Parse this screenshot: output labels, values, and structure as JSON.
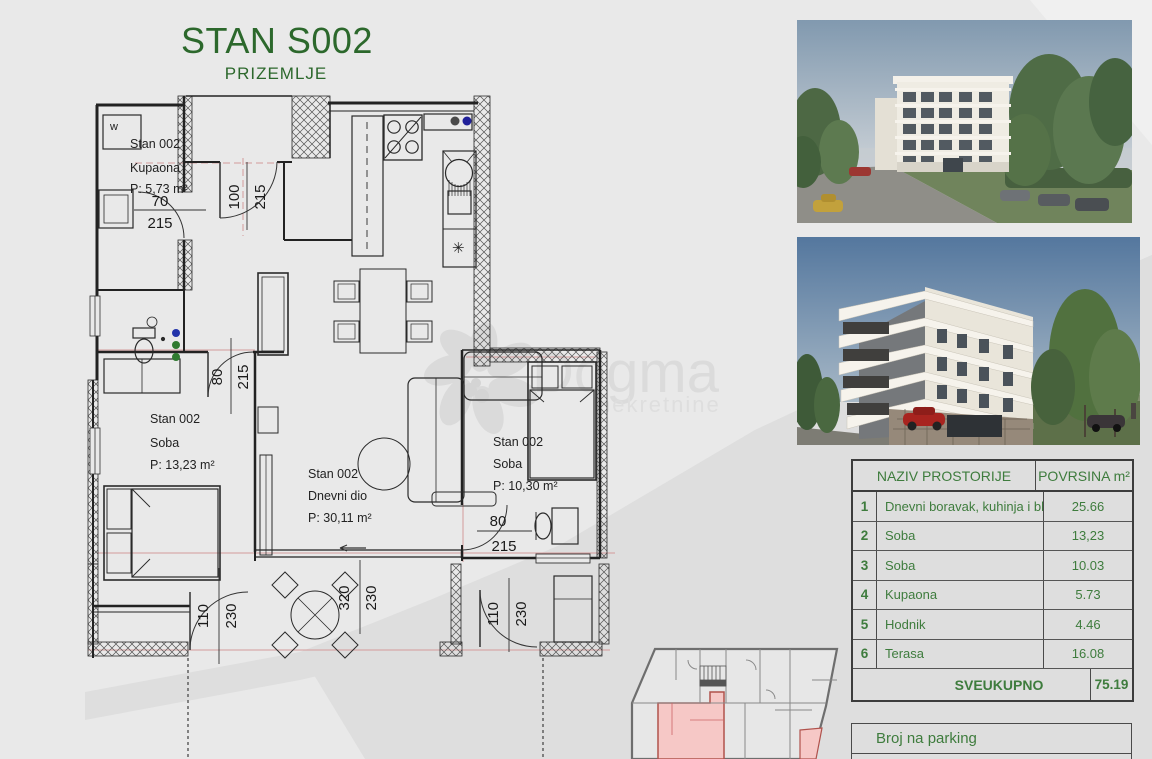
{
  "title": {
    "main": "STAN S002",
    "sub": "PRIZEMLJE"
  },
  "floorplan": {
    "rooms": {
      "kupaona": {
        "l1": "Stan 002",
        "l2": "Kupaona",
        "area": "P: 5,73 m²"
      },
      "soba1": {
        "l1": "Stan 002",
        "l2": "Soba",
        "area": "P: 13,23 m²"
      },
      "dnevni": {
        "l1": "Stan 002",
        "l2": "Dnevni dio",
        "area": "P: 30,11 m²"
      },
      "soba2": {
        "l1": "Stan 002",
        "l2": "Soba",
        "area": "P: 10,30 m²"
      }
    },
    "dims": {
      "d70": "70",
      "d80": "80",
      "d100": "100",
      "d110": "110",
      "d215": "215",
      "d230": "230",
      "d320": "320"
    },
    "symbols": {
      "washer": "w",
      "boiler": "✳"
    }
  },
  "watermark": {
    "brand": "Dogma",
    "sub": "nekretnine"
  },
  "area_table": {
    "header": {
      "name": "NAZIV PROSTORIJE",
      "area": "POVRSINA m²"
    },
    "rows": [
      {
        "num": "1",
        "name": "Dnevni boravak, kuhinja i blagov.",
        "area": "25.66"
      },
      {
        "num": "2",
        "name": "Soba",
        "area": "13,23"
      },
      {
        "num": "3",
        "name": "Soba",
        "area": "10.03"
      },
      {
        "num": "4",
        "name": "Kupaona",
        "area": "5.73"
      },
      {
        "num": "5",
        "name": "Hodnik",
        "area": "4.46"
      },
      {
        "num": "6",
        "name": "Terasa",
        "area": "16.08"
      }
    ],
    "total_label": "SVEUKUPNO",
    "total_value": "75.19"
  },
  "parking": {
    "label": "Broj na parking"
  },
  "colors": {
    "accent_green": "#2c682c",
    "table_green": "#3e7c3d",
    "bg": "#e9e9e9",
    "band": "#dedede",
    "unit_highlight": "#f6c8c6"
  }
}
